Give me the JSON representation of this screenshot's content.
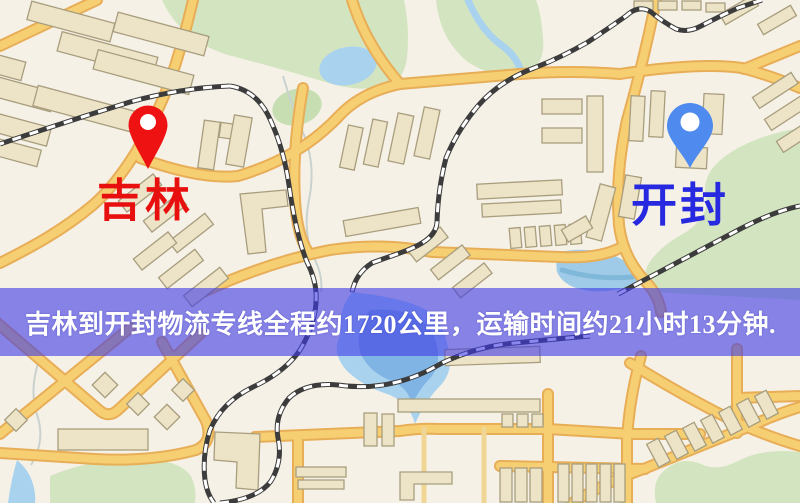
{
  "banner": {
    "text": "吉林到开封物流专线全程约1720公里，运输时间约21小时13分钟.",
    "bg_color": "rgba(62,58,230,0.60)",
    "text_color": "#ffffff"
  },
  "markers": [
    {
      "name": "origin",
      "label": "吉林",
      "pin_color": "#ee1212",
      "label_color": "#e8100e"
    },
    {
      "name": "destination",
      "label": "开封",
      "pin_color": "#4f8bef",
      "label_color": "#2629df"
    }
  ],
  "map_palette": {
    "background": "#f6f1e7",
    "road_fill": "#f6cf72",
    "road_casing": "#e8ae57",
    "park_green": "#d3e5c0",
    "water_blue": "#a9d2ef",
    "building_fill": "#ede4c8",
    "railway_dark": "#3c3c3c"
  }
}
